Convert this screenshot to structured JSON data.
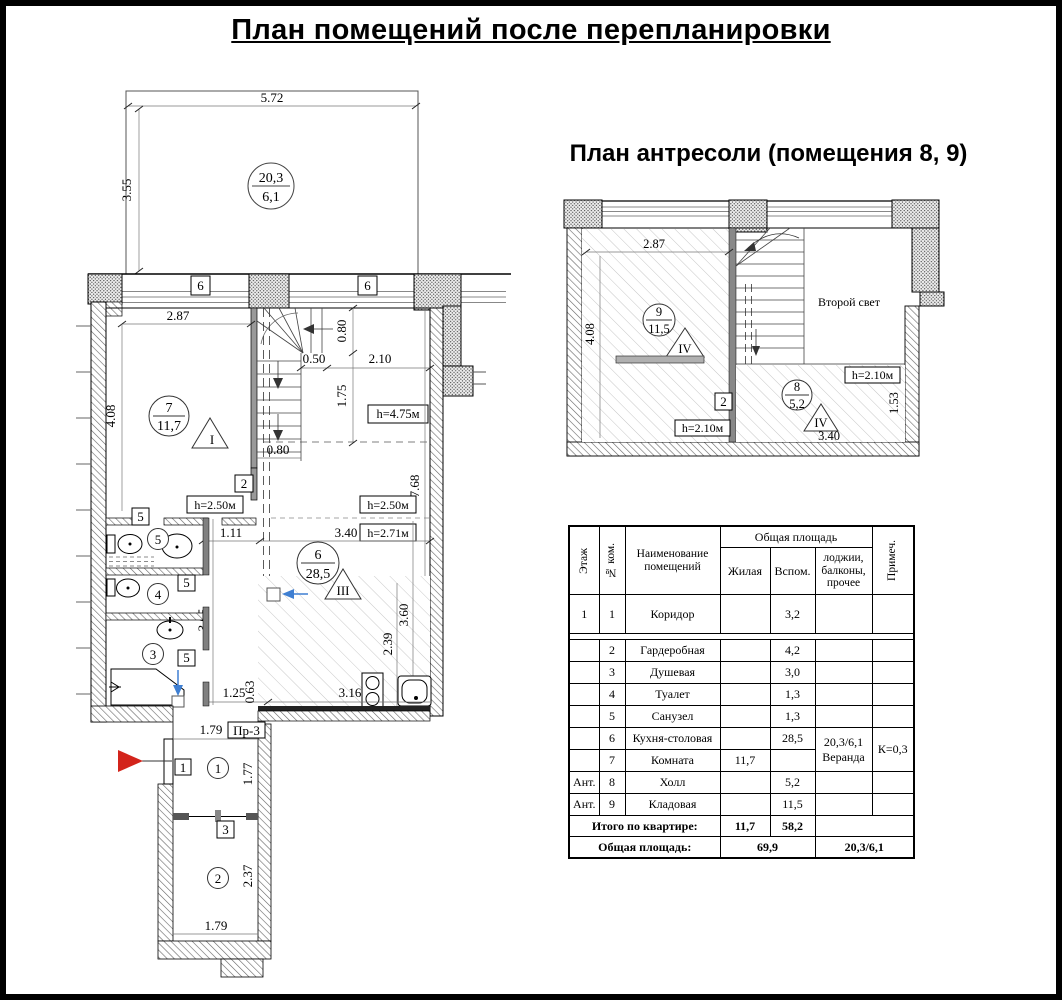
{
  "page": {
    "title": "План помещений после перепланировки"
  },
  "colors": {
    "entrance_arrow": "#d3241b",
    "view_marker": "#3f7fd2"
  },
  "mp": {
    "dim_572": "5.72",
    "dim_355": "3.55",
    "veranda_num": "20,3",
    "veranda_den": "6,1",
    "win6_left": "6",
    "win6_right": "6",
    "dim_287": "2.87",
    "dim_408": "4.08",
    "room7_num": "7",
    "room7_area": "11,7",
    "room7_zone": "I",
    "dim_080_top": "0.80",
    "dim_050": "0.50",
    "dim_210": "2.10",
    "dim_175": "1.75",
    "h475": "h=4.75м",
    "dim_080_mid": "0.80",
    "dim_768": "7.68",
    "door2": "2",
    "h250_left": "h=2.50м",
    "h250_right": "h=2.50м",
    "h271": "h=2.71м",
    "door5_a": "5",
    "door5_b": "5",
    "door5_c": "5",
    "room5_num": "5",
    "room4_num": "4",
    "room3_num": "3",
    "dim_111": "1.11",
    "dim_340": "3.40",
    "room6_num": "6",
    "room6_area": "28,5",
    "room6_zone": "III",
    "dim_365": "3.65",
    "dim_360": "3.60",
    "dim_239": "2.39",
    "dim_125": "1.25",
    "dim_063": "0.63",
    "dim_316": "3.16",
    "dim_179_top": "1.79",
    "pr3": "Пр-3",
    "door1": "1",
    "room1_num": "1",
    "dim_177": "1.77",
    "door3": "3",
    "room2_num": "2",
    "dim_237": "2.37",
    "dim_179_bottom": "1.79"
  },
  "mz": {
    "title": "План антресоли (помещения 8, 9)",
    "dim_287": "2.87",
    "dim_408": "4.08",
    "room9_num": "9",
    "room9_area": "11,5",
    "room9_zone": "IV",
    "second_light": "Второй свет",
    "door2": "2",
    "h210_left": "h=2.10м",
    "h210_right": "h=2.10м",
    "room8_num": "8",
    "room8_area": "5,2",
    "room8_zone": "IV",
    "dim_340": "3.40",
    "dim_153": "1.53"
  },
  "table": {
    "header": {
      "col_floor": "Этаж",
      "col_room": "№ ком.",
      "col_name": "Наименование помещений",
      "group_total": "Общая площадь",
      "col_living": "Жилая",
      "col_aux": "Вспом.",
      "col_loggia": "лоджии, балконы, прочее",
      "col_note": "Примеч."
    },
    "rows": [
      {
        "floor": "1",
        "num": "1",
        "name": "Коридор",
        "living": "",
        "aux": "3,2"
      },
      {
        "floor": "",
        "num": "2",
        "name": "Гардеробная",
        "living": "",
        "aux": "4,2"
      },
      {
        "floor": "",
        "num": "3",
        "name": "Душевая",
        "living": "",
        "aux": "3,0"
      },
      {
        "floor": "",
        "num": "4",
        "name": "Туалет",
        "living": "",
        "aux": "1,3"
      },
      {
        "floor": "",
        "num": "5",
        "name": "Санузел",
        "living": "",
        "aux": "1,3"
      },
      {
        "floor": "",
        "num": "6",
        "name": "Кухня-столовая",
        "living": "",
        "aux": "28,5"
      },
      {
        "floor": "",
        "num": "7",
        "name": "Комната",
        "living": "11,7",
        "aux": ""
      },
      {
        "floor": "Ант.",
        "num": "8",
        "name": "Холл",
        "living": "",
        "aux": "5,2"
      },
      {
        "floor": "Ант.",
        "num": "9",
        "name": "Кладовая",
        "living": "",
        "aux": "11,5"
      }
    ],
    "merged": {
      "loggia_line1": "20,3/6,1",
      "loggia_line2": "Веранда",
      "note": "К=0,3"
    },
    "totals": {
      "label": "Итого по квартире:",
      "living": "11,7",
      "aux": "58,2"
    },
    "grand": {
      "label": "Общая площадь:",
      "value": "69,9",
      "loggia": "20,3/6,1"
    }
  }
}
